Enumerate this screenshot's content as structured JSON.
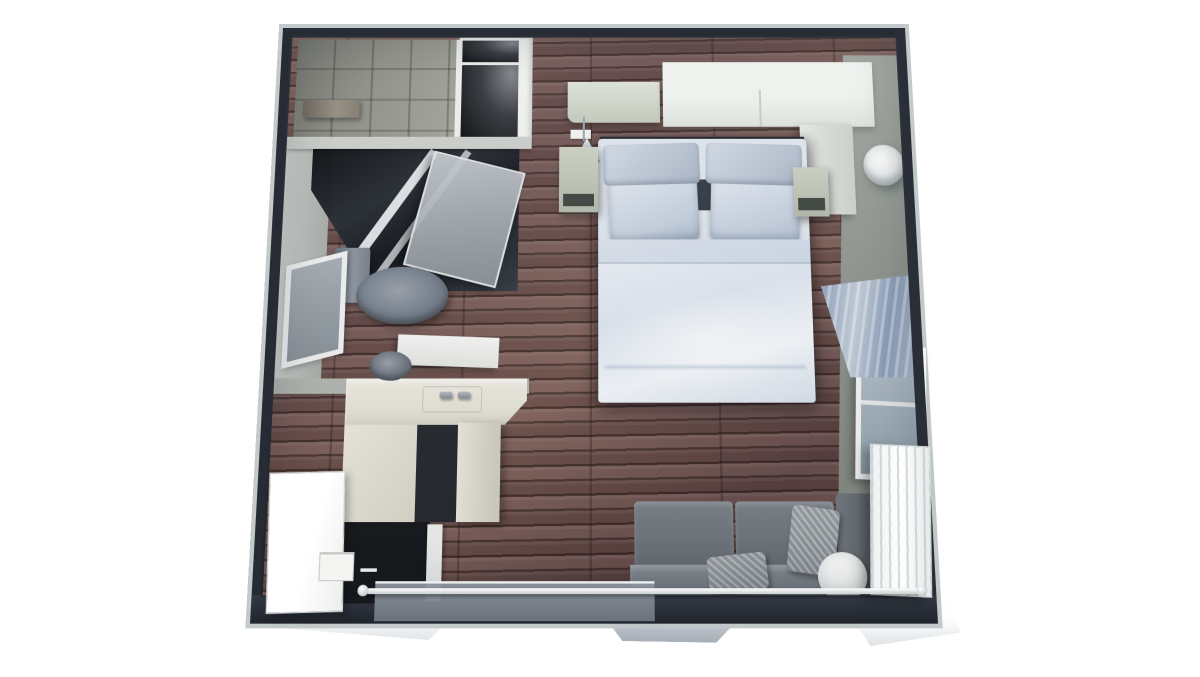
{
  "scene": {
    "name": "studio-apartment-3d-floor-plan",
    "view": "top-down perspective render",
    "width": 1200,
    "height": 677,
    "background": "#ffffff"
  },
  "palette": {
    "wall-dark": "#272b33",
    "wall-outer": "#c1c7c7",
    "wood-base": "#6e5150",
    "wood-dark": "#473432",
    "tile-floor": "#96978d",
    "wall-face-gray": "#99a097",
    "cabinet-white": "#f2f4f1",
    "counter-cream": "#eae7dc",
    "glass-dark": "#15181d",
    "fixture-gray": "#7c8490",
    "duvet-white": "#e9eef5",
    "pillow-blue-gray": "#c6d1df",
    "pillow-accent-dark": "#3a414b",
    "nightstand-green": "#c4cabc",
    "sofa-gray": "#757b82",
    "throw-pillow-gray": "#9aa1a6",
    "curtain-blue": "#8fa2bd",
    "radiator-white": "#f7fafa",
    "door-silver": "#d7dcdf",
    "entry-dark": "#17191d"
  },
  "rooms": {
    "sleeping_area": "Sleeping area",
    "bathroom": "Bathroom",
    "shower_room": "Tiled shower room",
    "wardrobe": "Wardrobe compartments",
    "kitchenette": "Kitchenette",
    "living_area": "Living area",
    "entry": "Entry"
  },
  "furniture": {
    "bed": "Double bed with white duvet",
    "pillows": "Blue-gray pillows with dark accent cushions",
    "bridge_cabinet": "Overhead bridge cabinet",
    "floating_shelf": "Floating shelf",
    "pendant_lamp": "Pendant lamp",
    "nightstand_left": "Left nightstand",
    "nightstand_right": "Right nightstand",
    "wardrobe_return": "Wardrobe side unit",
    "sconce": "Round wall sconce",
    "window_right": "Window with blue curtain",
    "curtain": "Blue drape",
    "radiator": "White panel radiator",
    "sofa": "Gray sofa",
    "throw_pillows": "Knit throw pillows",
    "bolster": "White round bolster",
    "sliding_door": "Sliding glass door",
    "handle_bar": "Long door handle bar",
    "shower": "Dark glass shower enclosure",
    "shower_door": "Glass shower door",
    "toilet": "Toilet",
    "sink": "Washbasin vanity",
    "west_window": "Bathroom window",
    "tiled_bench": "Shower bench",
    "closets": "Dark storage compartments",
    "kitchen_counter": "L-shaped kitchen counter",
    "taps": "Sink taps",
    "fridge": "Tall white cabinet / fridge",
    "entry_mat": "Dark entry mat",
    "mini_cabinet": "Small drawer cabinet"
  }
}
